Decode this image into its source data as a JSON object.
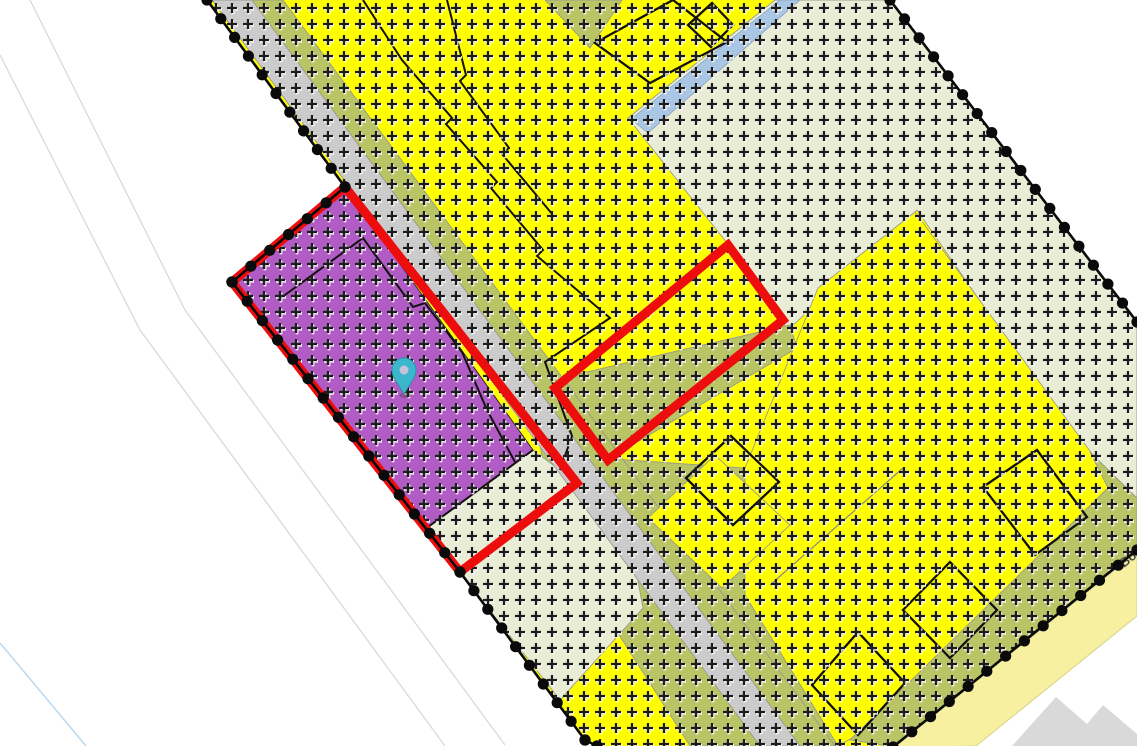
{
  "map": {
    "width": 1137,
    "height": 746,
    "background": "#ffffff",
    "colors": {
      "zone_yellow": "#ffff00",
      "zone_olive": "#b9c464",
      "zone_pale_green": "#e9edd5",
      "zone_gray_road": "#cbcbcb",
      "zone_blue": "#a9c7e5",
      "zone_purple": "#b15cc4",
      "road_yellow": "#f6f0a0",
      "selection_red": "#ee0d0d",
      "boundary_black": "#0a0a0a",
      "hatch_black": "#1c1c1c",
      "building_outline": "#111111",
      "faint_pink": "#e2d6d2",
      "faint_blue": "#b9d9f2",
      "outside_building_gray": "#d9d9d9",
      "pin_teal": "#3ab7cd"
    },
    "boundary_clip": [
      [
        207,
        0
      ],
      [
        890,
        0
      ],
      [
        1137,
        322
      ],
      [
        1137,
        550
      ],
      [
        893,
        747
      ],
      [
        597,
        746
      ],
      [
        585,
        740
      ],
      [
        460,
        572
      ],
      [
        232,
        282
      ],
      [
        345,
        187
      ]
    ],
    "faint_lines": [
      {
        "name": "faint-road-edge-1",
        "color": "#e2d6d2",
        "width": 1.3,
        "points": [
          [
            30,
            0
          ],
          [
            185,
            310
          ],
          [
            505,
            745
          ]
        ]
      },
      {
        "name": "faint-road-edge-2",
        "color": "#e2d6d2",
        "width": 1.3,
        "points": [
          [
            0,
            55
          ],
          [
            140,
            330
          ],
          [
            445,
            746
          ]
        ]
      },
      {
        "name": "faint-road-edge-blue",
        "color": "#b9d9f2",
        "width": 1.5,
        "points": [
          [
            0,
            643
          ],
          [
            86,
            746
          ]
        ]
      }
    ],
    "zones": [
      {
        "name": "zone-residential-yellow-base",
        "color": "#ffff00",
        "stroke": "none",
        "points": [
          [
            207,
            0
          ],
          [
            890,
            0
          ],
          [
            1137,
            322
          ],
          [
            1137,
            550
          ],
          [
            893,
            747
          ],
          [
            597,
            746
          ],
          [
            585,
            740
          ],
          [
            460,
            572
          ],
          [
            232,
            282
          ],
          [
            345,
            187
          ]
        ]
      },
      {
        "name": "zone-pale-green-northeast",
        "color": "#e9edd5",
        "stroke": "#9b9b8f",
        "points": [
          [
            775,
            0
          ],
          [
            890,
            0
          ],
          [
            1137,
            322
          ],
          [
            1137,
            515
          ],
          [
            1090,
            460
          ],
          [
            917,
            210
          ],
          [
            788,
            330
          ],
          [
            727,
            243
          ],
          [
            628,
            118
          ]
        ]
      },
      {
        "name": "zone-olive-wedge-top",
        "color": "#b9c464",
        "stroke": "#9b9b8f",
        "points": [
          [
            545,
            0
          ],
          [
            622,
            0
          ],
          [
            590,
            48
          ]
        ]
      },
      {
        "name": "zone-olive-band-center",
        "color": "#b9c464",
        "stroke": "#9b9b8f",
        "points": [
          [
            530,
            385
          ],
          [
            790,
            325
          ],
          [
            797,
            348
          ],
          [
            610,
            458
          ],
          [
            545,
            475
          ]
        ]
      },
      {
        "name": "zone-olive-south",
        "color": "#b9c464",
        "stroke": "#9b9b8f",
        "points": [
          [
            520,
            480
          ],
          [
            613,
            459
          ],
          [
            745,
            468
          ],
          [
            745,
            595
          ],
          [
            838,
            746
          ],
          [
            690,
            746
          ]
        ]
      },
      {
        "name": "zone-yellow-southeast-parcel",
        "color": "#ffff00",
        "stroke": "#9b9b8f",
        "points": [
          [
            915,
            212
          ],
          [
            1095,
            458
          ],
          [
            1112,
            488
          ],
          [
            852,
            738
          ],
          [
            838,
            746
          ],
          [
            745,
            595
          ],
          [
            745,
            468
          ],
          [
            818,
            288
          ]
        ]
      },
      {
        "name": "zone-olive-road-band-southeast",
        "color": "#b9c464",
        "stroke": "#9b9b8f",
        "points": [
          [
            1090,
            452
          ],
          [
            1137,
            498
          ],
          [
            1137,
            552
          ],
          [
            895,
            747
          ],
          [
            850,
            740
          ],
          [
            1108,
            488
          ]
        ]
      },
      {
        "name": "zone-pale-green-below-selection",
        "color": "#e9edd5",
        "stroke": "#9b9b8f",
        "points": [
          [
            428,
            527
          ],
          [
            533,
            450
          ],
          [
            577,
            483
          ],
          [
            634,
            560
          ],
          [
            643,
            608
          ],
          [
            560,
            700
          ],
          [
            460,
            572
          ]
        ]
      },
      {
        "name": "zone-gray-road-strip",
        "color": "#cbcbcb",
        "stroke": "#9b9b8f",
        "points": [
          [
            212,
            0
          ],
          [
            252,
            0
          ],
          [
            800,
            746
          ],
          [
            760,
            746
          ]
        ]
      },
      {
        "name": "zone-olive-roadside-strip",
        "color": "#b9c464",
        "stroke": "#9b9b8f",
        "points": [
          [
            252,
            0
          ],
          [
            283,
            0
          ],
          [
            835,
            746
          ],
          [
            800,
            746
          ]
        ]
      },
      {
        "name": "zone-yellow-island-parcel",
        "color": "#ffff00",
        "stroke": "#9b9b8f",
        "points": [
          [
            648,
            518
          ],
          [
            715,
            455
          ],
          [
            790,
            525
          ],
          [
            722,
            588
          ]
        ]
      },
      {
        "name": "zone-blue-strip",
        "color": "#a9c7e5",
        "stroke": "#8fa7c5",
        "points": [
          [
            780,
            0
          ],
          [
            800,
            0
          ],
          [
            648,
            133
          ],
          [
            631,
            119
          ]
        ]
      },
      {
        "name": "zone-purple-selected-parcel",
        "color": "#b15cc4",
        "stroke": "#222222",
        "points": [
          [
            345,
            187
          ],
          [
            232,
            282
          ],
          [
            428,
            527
          ],
          [
            533,
            450
          ]
        ]
      }
    ],
    "parcel_lines": [
      {
        "name": "purple-parcel-south-edge",
        "color": "#111111",
        "width": 2,
        "points": [
          [
            428,
            527
          ],
          [
            533,
            450
          ]
        ]
      },
      {
        "name": "purple-inner-lot-line",
        "color": "#111111",
        "width": 2,
        "points": [
          [
            278,
            300
          ],
          [
            363,
            238
          ],
          [
            413,
            307
          ],
          [
            425,
            303
          ],
          [
            462,
            352
          ],
          [
            487,
            410
          ],
          [
            515,
            462
          ]
        ]
      },
      {
        "name": "lot-zigzag-line-a",
        "color": "#111111",
        "width": 2,
        "points": [
          [
            363,
            0
          ],
          [
            402,
            60
          ],
          [
            452,
            118
          ],
          [
            446,
            124
          ],
          [
            497,
            182
          ],
          [
            491,
            188
          ],
          [
            543,
            250
          ],
          [
            537,
            256
          ],
          [
            610,
            318
          ],
          [
            545,
            362
          ],
          [
            572,
            436
          ],
          [
            560,
            470
          ]
        ]
      },
      {
        "name": "lot-zigzag-line-b",
        "color": "#111111",
        "width": 2,
        "points": [
          [
            447,
            0
          ],
          [
            466,
            75
          ],
          [
            460,
            81
          ],
          [
            509,
            148
          ],
          [
            502,
            154
          ],
          [
            553,
            215
          ]
        ]
      },
      {
        "name": "thin-parcel-line-southeast",
        "color": "#8a8a8a",
        "width": 1.2,
        "points": [
          [
            903,
            468
          ],
          [
            770,
            585
          ]
        ]
      }
    ],
    "buildings": [
      {
        "name": "building-footprint-top-large",
        "points": [
          [
            595,
            43
          ],
          [
            673,
            0
          ],
          [
            727,
            42
          ],
          [
            650,
            83
          ]
        ]
      },
      {
        "name": "building-footprint-top-small",
        "points": [
          [
            688,
            25
          ],
          [
            712,
            3
          ],
          [
            733,
            25
          ],
          [
            711,
            47
          ]
        ]
      },
      {
        "name": "building-footprint-island",
        "points": [
          [
            686,
            478
          ],
          [
            731,
            436
          ],
          [
            779,
            482
          ],
          [
            733,
            525
          ]
        ]
      },
      {
        "name": "building-footprint-se-1",
        "points": [
          [
            983,
            487
          ],
          [
            1037,
            450
          ],
          [
            1087,
            517
          ],
          [
            1035,
            555
          ]
        ]
      },
      {
        "name": "building-footprint-se-2",
        "points": [
          [
            903,
            610
          ],
          [
            950,
            562
          ],
          [
            997,
            610
          ],
          [
            950,
            658
          ]
        ]
      },
      {
        "name": "building-footprint-se-3",
        "points": [
          [
            812,
            685
          ],
          [
            858,
            632
          ],
          [
            905,
            683
          ],
          [
            858,
            735
          ]
        ]
      }
    ],
    "boundary": {
      "name": "plan-area-boundary",
      "color": "#0a0a0a",
      "line_width": 2.6,
      "dot_radius": 5.6,
      "dot_spacing": 24,
      "segments": [
        [
          [
            207,
            0
          ],
          [
            345,
            187
          ],
          [
            232,
            282
          ],
          [
            460,
            572
          ],
          [
            585,
            740
          ],
          [
            597,
            746
          ]
        ],
        [
          [
            890,
            0
          ],
          [
            1137,
            322
          ]
        ],
        [
          [
            1137,
            550
          ],
          [
            893,
            747
          ]
        ]
      ]
    },
    "selection_outlines": [
      {
        "name": "selected-parcel-outline-west",
        "color": "#ee0d0d",
        "width": 9,
        "points": [
          [
            345,
            187
          ],
          [
            232,
            282
          ],
          [
            460,
            572
          ],
          [
            577,
            483
          ]
        ]
      },
      {
        "name": "selected-parcel-outline-east",
        "color": "#ee0d0d",
        "width": 9,
        "points": [
          [
            555,
            388
          ],
          [
            728,
            245
          ],
          [
            783,
            320
          ],
          [
            608,
            460
          ]
        ]
      }
    ],
    "outside": {
      "yellow_road": {
        "name": "road-surface-southeast",
        "color": "#f6f0a0",
        "stroke": "#d9d28a",
        "points": [
          [
            1137,
            552
          ],
          [
            1137,
            616
          ],
          [
            976,
            746
          ],
          [
            893,
            748
          ]
        ]
      },
      "gray_building": {
        "name": "building-outside-boundary",
        "color": "#d9d9d9",
        "points": [
          [
            1012,
            746
          ],
          [
            1056,
            697
          ],
          [
            1087,
            724
          ],
          [
            1103,
            705
          ],
          [
            1137,
            734
          ],
          [
            1137,
            746
          ]
        ]
      }
    },
    "road_label": {
      "text": "Bo",
      "x": 1124,
      "y": 568,
      "angle": -39,
      "color": "#4a4a4a",
      "size": 13
    },
    "hatch": {
      "spacing": 16,
      "arm": 10,
      "width": 2.3,
      "color": "#1c1c1c",
      "shadow": "#ffffff"
    },
    "marker": {
      "name": "location-pin",
      "x": 404,
      "y": 394,
      "color": "#3ab7cd",
      "hole": "#c6c3da"
    }
  }
}
